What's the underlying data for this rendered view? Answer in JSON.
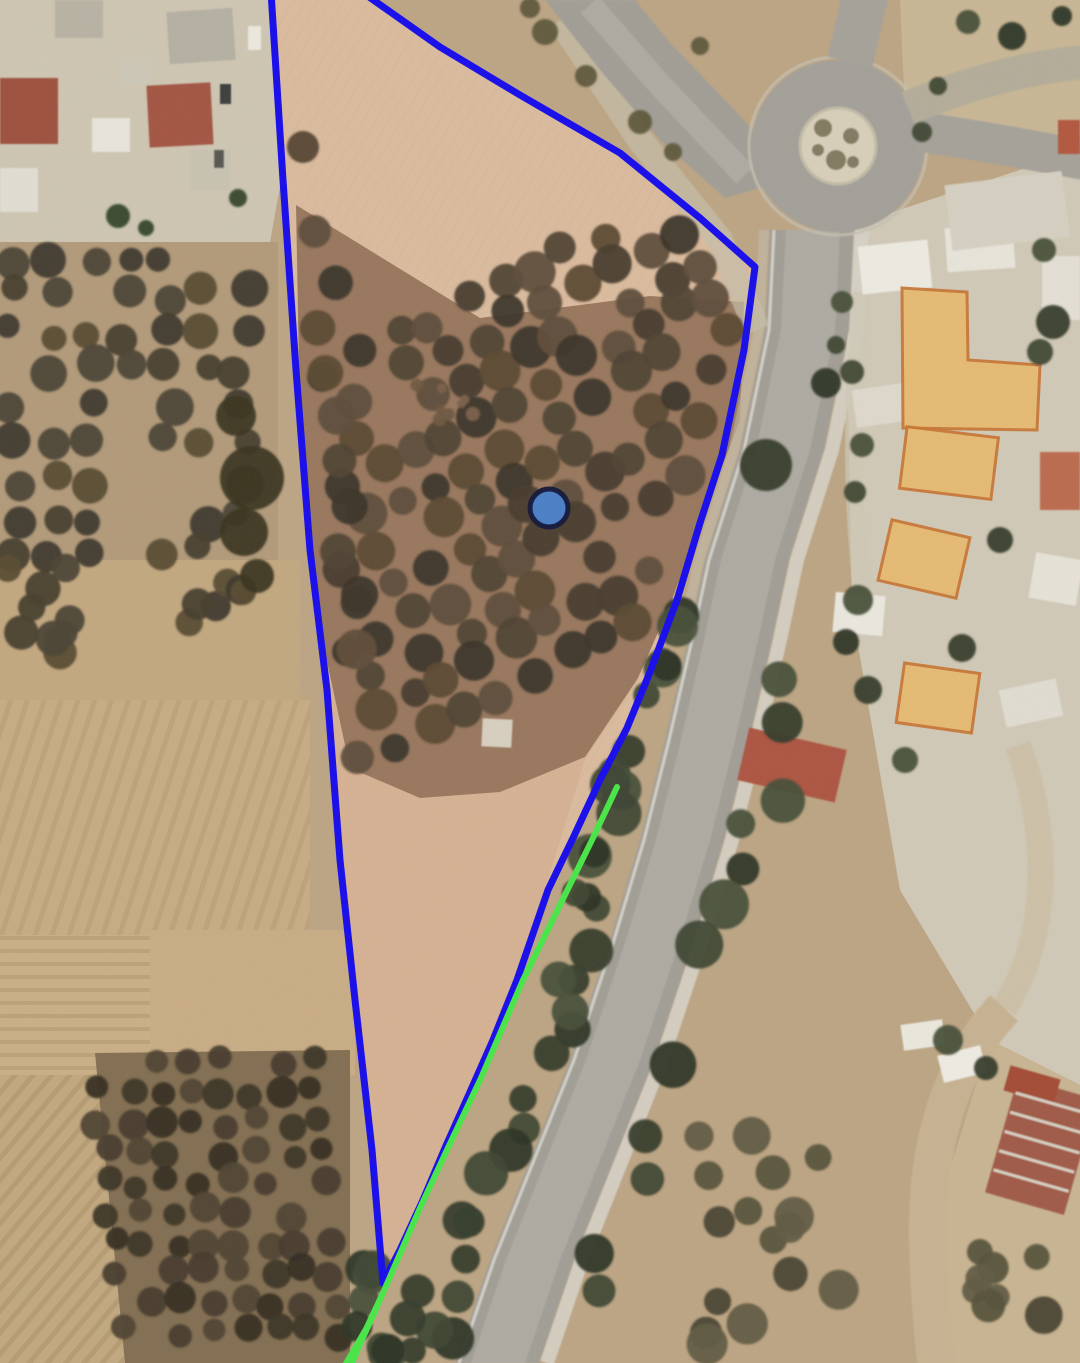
{
  "map": {
    "view": "satellite",
    "overlay": {
      "parcel_boundary": {
        "color": "#1c12e9",
        "stroke_width": 7,
        "points": "271,-8 283,180 296,370 310,550 327,690 340,860 355,1000 372,1150 383,1283 400,1250 423,1200 445,1148 470,1092 493,1040 517,980 548,890 574,836 600,780 627,728 650,672 677,600 700,523 722,455 744,350 755,267 700,218 620,153 520,95 440,47 362,-8"
      },
      "route_highlight": {
        "color": "#4be44b",
        "stroke_width": 6,
        "points": "617,787 593,838 561,903 523,980 481,1078 446,1152 420,1208 399,1256 386,1286 371,1320 359,1346 351,1366",
        "secondary_points": "382,1294 366,1328 351,1354 344,1366"
      },
      "marker": {
        "x": 549,
        "y": 508,
        "radius": 19,
        "fill": "#4d80c4",
        "stroke": "#1b1e3e",
        "stroke_width": 5
      },
      "highlighted_buildings": {
        "fill": "#e9ba6c",
        "stroke": "#c8742f",
        "stroke_width": 3
      }
    }
  }
}
